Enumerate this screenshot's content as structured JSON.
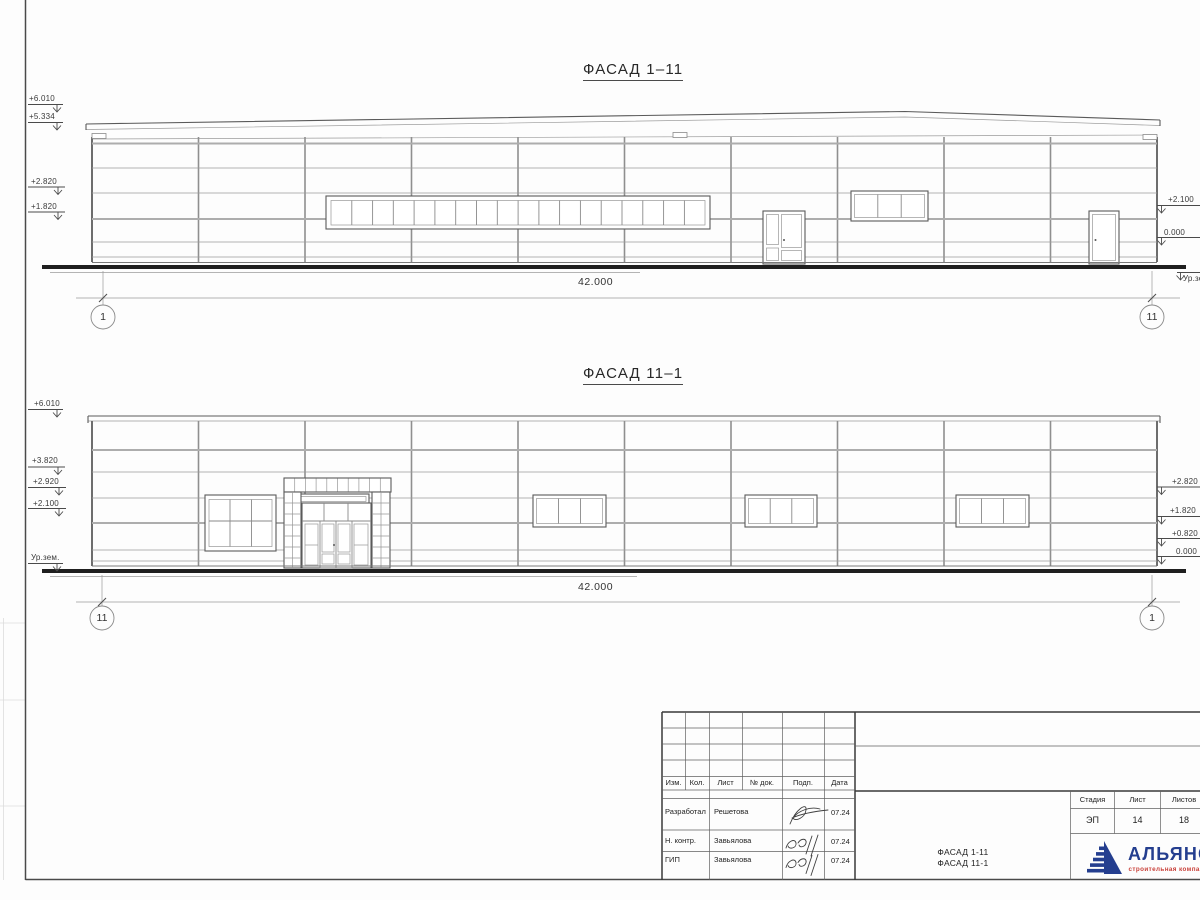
{
  "colors": {
    "logo_blue": "#243e8f",
    "logo_red": "#c9413a"
  },
  "facade_top": {
    "title": "ФАСАД 1–11",
    "marks_left": [
      "+6.010",
      "+5.334",
      "+2.820",
      "+1.820"
    ],
    "marks_right": [
      "+2.100",
      "0.000",
      "Ур.зем."
    ],
    "dimension": "42.000",
    "axis_left": "1",
    "axis_right": "11"
  },
  "facade_bottom": {
    "title": "ФАСАД 11–1",
    "marks_left": [
      "+6.010",
      "+3.820",
      "+2.920",
      "+2.100",
      "Ур.зем."
    ],
    "marks_right": [
      "+2.820",
      "+1.820",
      "+0.820",
      "0.000"
    ],
    "dimension": "42.000",
    "axis_left": "11",
    "axis_right": "1"
  },
  "title_block": {
    "header_cols": [
      "Изм.",
      "Кол.",
      "Лист",
      "№ док.",
      "Подп.",
      "Дата"
    ],
    "rows": [
      {
        "role": "Разработал",
        "name": "Решетова",
        "date": "07.24"
      },
      {
        "role": "Н. контр.",
        "name": "Завьялова",
        "date": "07.24"
      },
      {
        "role": "ГИП",
        "name": "Завьялова",
        "date": "07.24"
      }
    ],
    "stage_label": "Стадия",
    "sheet_label": "Лист",
    "sheets_label": "Листов",
    "stage": "ЭП",
    "sheet_no": "14",
    "sheets_total": "18",
    "drawing_title_line1": "ФАСАД 1-11",
    "drawing_title_line2": "ФАСАД 11-1",
    "company_name": "АЛЬЯНС",
    "company_tagline": "строительная компания"
  }
}
